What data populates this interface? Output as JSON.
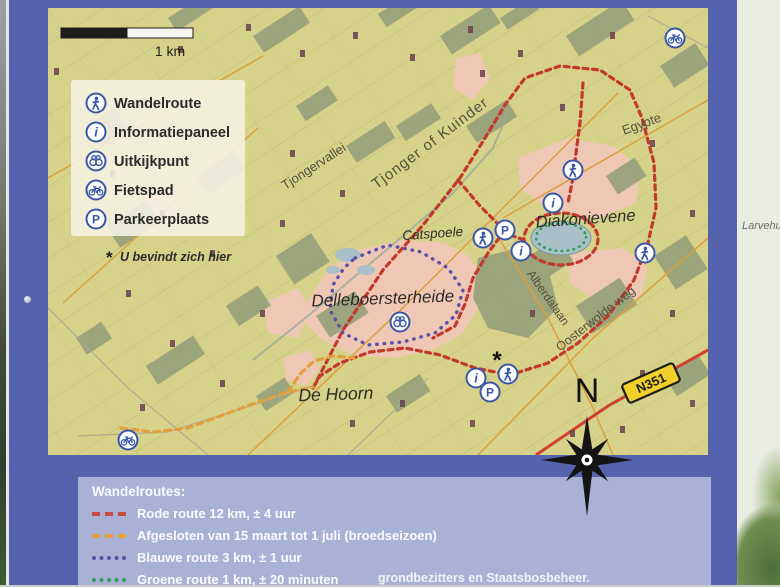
{
  "sign": {
    "map": {
      "scale_label": "1 km",
      "legend_box": {
        "items": [
          {
            "icon": "walker-icon",
            "label": "Wandelroute"
          },
          {
            "icon": "info-icon",
            "label": "Informatiepaneel"
          },
          {
            "icon": "viewpoint-icon",
            "label": "Uitkijkpunt"
          },
          {
            "icon": "bicycle-icon",
            "label": "Fietspad"
          },
          {
            "icon": "parking-icon",
            "label": "Parkeerplaats"
          }
        ],
        "you_are_here_symbol": "*",
        "you_are_here_label": "U bevindt zich hier"
      },
      "icon_glyphs": {
        "info": "i",
        "parking": "P"
      },
      "place_labels": {
        "tjongervallei": "Tjongervallei",
        "river": "Tjonger of Kuinder",
        "egypte": "Egypte",
        "diakonievene": "Diakonievene",
        "catspoele": "Catspoele",
        "alberdalaan": "Alberdalaan",
        "oosterwolde_weg": "Oosterwolde weg",
        "delleboersterheide": "Delleboersterheide",
        "de_hoorn": "De Hoorn"
      },
      "road_badge": "N351",
      "compass_letter": "N",
      "you_are_here_symbol": "*"
    },
    "routes_panel": {
      "title": "Wandelroutes:",
      "items": [
        {
          "label": "Rode route 12 km, ± 4 uur",
          "color": "#c84b42",
          "style": "dashed"
        },
        {
          "label": "Afgesloten van 15 maart tot 1 juli (broedseizoen)",
          "color": "#e7a03c",
          "style": "dashed"
        },
        {
          "label": "Blauwe route 3 km, ± 1 uur",
          "color": "#5a50a8",
          "style": "dotted"
        },
        {
          "label": "Groene route 1 km, ± 20 minuten",
          "color": "#2f9e57",
          "style": "dotted"
        }
      ],
      "footer_partial": "grondbezitters en Staatsbosbeheer."
    },
    "colors": {
      "frame_blue": "#5563ae",
      "map_background": "#d7d289",
      "panel_background": "#a9b2d4",
      "heath_pink": "#eec8b4",
      "forest_green": "#96a07a",
      "water_blue": "#a9c0c8",
      "route_red": "#c2392e",
      "route_closed_orange": "#e2a03f",
      "route_blue": "#5a50a8",
      "route_green": "#2f9e57",
      "n351_yellow": "#f2d02b",
      "icon_blue": "#3a57a7"
    }
  },
  "surroundings": {
    "adjacent_panel_text_partial": "Larvehu"
  }
}
